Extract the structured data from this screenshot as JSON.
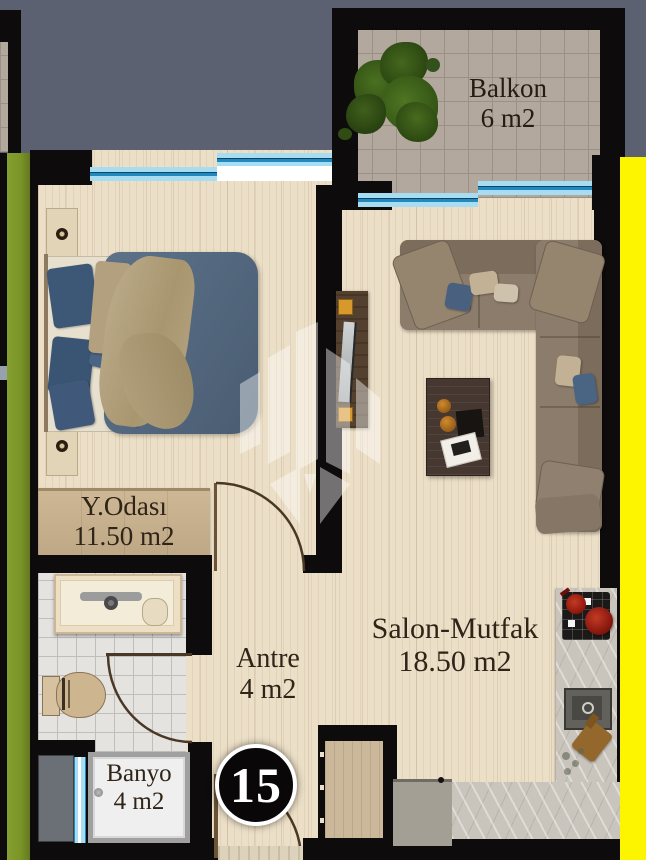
{
  "floor_plan": {
    "unit_number": "15",
    "rooms": [
      {
        "name": "Balkon",
        "area": "6 m2"
      },
      {
        "name": "Y.Odası",
        "area": "11.50 m2"
      },
      {
        "name": "Antre",
        "area": "4 m2"
      },
      {
        "name": "Salon-Mutfak",
        "area": "18.50 m2"
      },
      {
        "name": "Banyo",
        "area": "4 m2"
      }
    ],
    "colors": {
      "background": "#5b6170",
      "walls": "#0e0b0c",
      "floor_wood": "#ecdfc7",
      "balcony_tile": "#b3a89d",
      "bathroom_tile": "#e5e3e0",
      "window_blue_light": "#a8dcf0",
      "window_blue_dark": "#1f89c0",
      "exterior_strip_left_green": "#7a9427",
      "exterior_strip_right_yellow": "#fdf500",
      "label_text": "#2f2417",
      "badge_bg": "#0a0708",
      "badge_text": "#ffffff"
    }
  }
}
